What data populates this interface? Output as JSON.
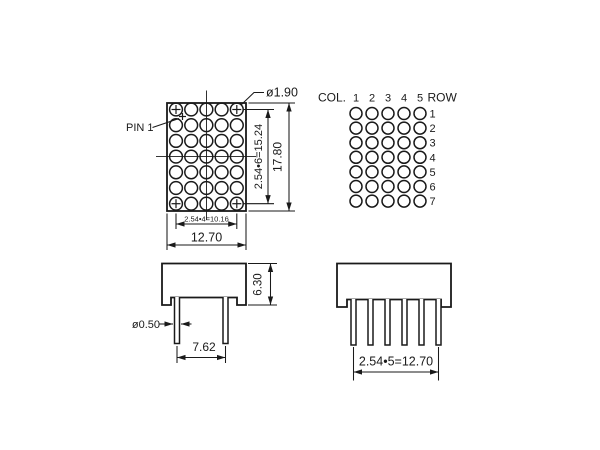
{
  "front_view": {
    "pin1_label": "PIN 1",
    "dot_diameter": "ø1.90",
    "row_pitch_total": "2.54•6=15.24",
    "body_height": "17.80",
    "col_pitch_total": "2.54•4=10.16",
    "body_width": "12.70",
    "grid": {
      "cols": 5,
      "rows": 7
    }
  },
  "pin_map": {
    "col_label": "COL.",
    "row_label": "ROW",
    "col_numbers": [
      "1",
      "2",
      "3",
      "4",
      "5"
    ],
    "row_numbers": [
      "1",
      "2",
      "3",
      "4",
      "5",
      "6",
      "7"
    ],
    "grid": {
      "cols": 5,
      "rows": 7
    }
  },
  "side_view": {
    "body_depth": "6.30",
    "pin_diameter": "ø0.50",
    "pin_spacing": "7.62"
  },
  "bottom_view": {
    "pin_row_span": "2.54•5=12.70"
  },
  "colors": {
    "line": "#1a1a1a",
    "background": "#ffffff"
  }
}
